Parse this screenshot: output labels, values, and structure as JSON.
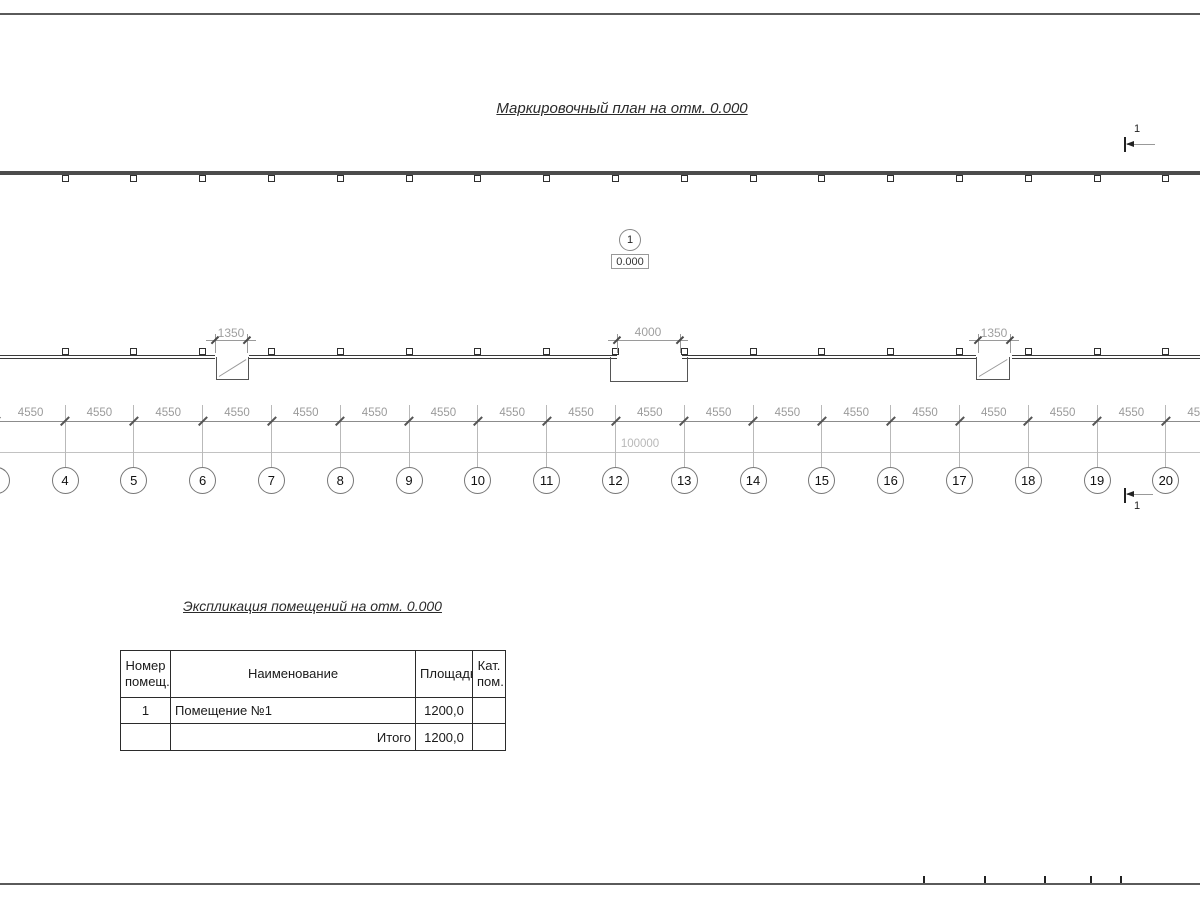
{
  "page_title": "Маркировочный план на отм. 0.000",
  "plan": {
    "room_marker": {
      "number": "1",
      "elevation": "0.000"
    },
    "section_marks": {
      "top": "1",
      "bottom": "1"
    },
    "opening_dims": [
      "1350",
      "4000",
      "1350"
    ],
    "axis_numbers": [
      "4",
      "5",
      "6",
      "7",
      "8",
      "9",
      "10",
      "11",
      "12",
      "13",
      "14",
      "15",
      "16",
      "17",
      "18",
      "19",
      "20"
    ],
    "bay_dims": [
      "4550",
      "4550",
      "4550",
      "4550",
      "4550",
      "4550",
      "4550",
      "4550",
      "4550",
      "4550",
      "4550",
      "4550",
      "4550",
      "4550",
      "4550",
      "4550",
      "4550",
      "4550"
    ],
    "total_dim": "100000"
  },
  "schedule": {
    "title": "Экспликация помещений на отм. 0.000",
    "headers": [
      "Номер помещ.",
      "Наименование",
      "Площадь",
      "Кат. пом."
    ],
    "rows": [
      {
        "number": "1",
        "name": "Помещение №1",
        "area": "1200,0",
        "category": ""
      }
    ],
    "total_label": "Итого",
    "total_area": "1200,0"
  }
}
